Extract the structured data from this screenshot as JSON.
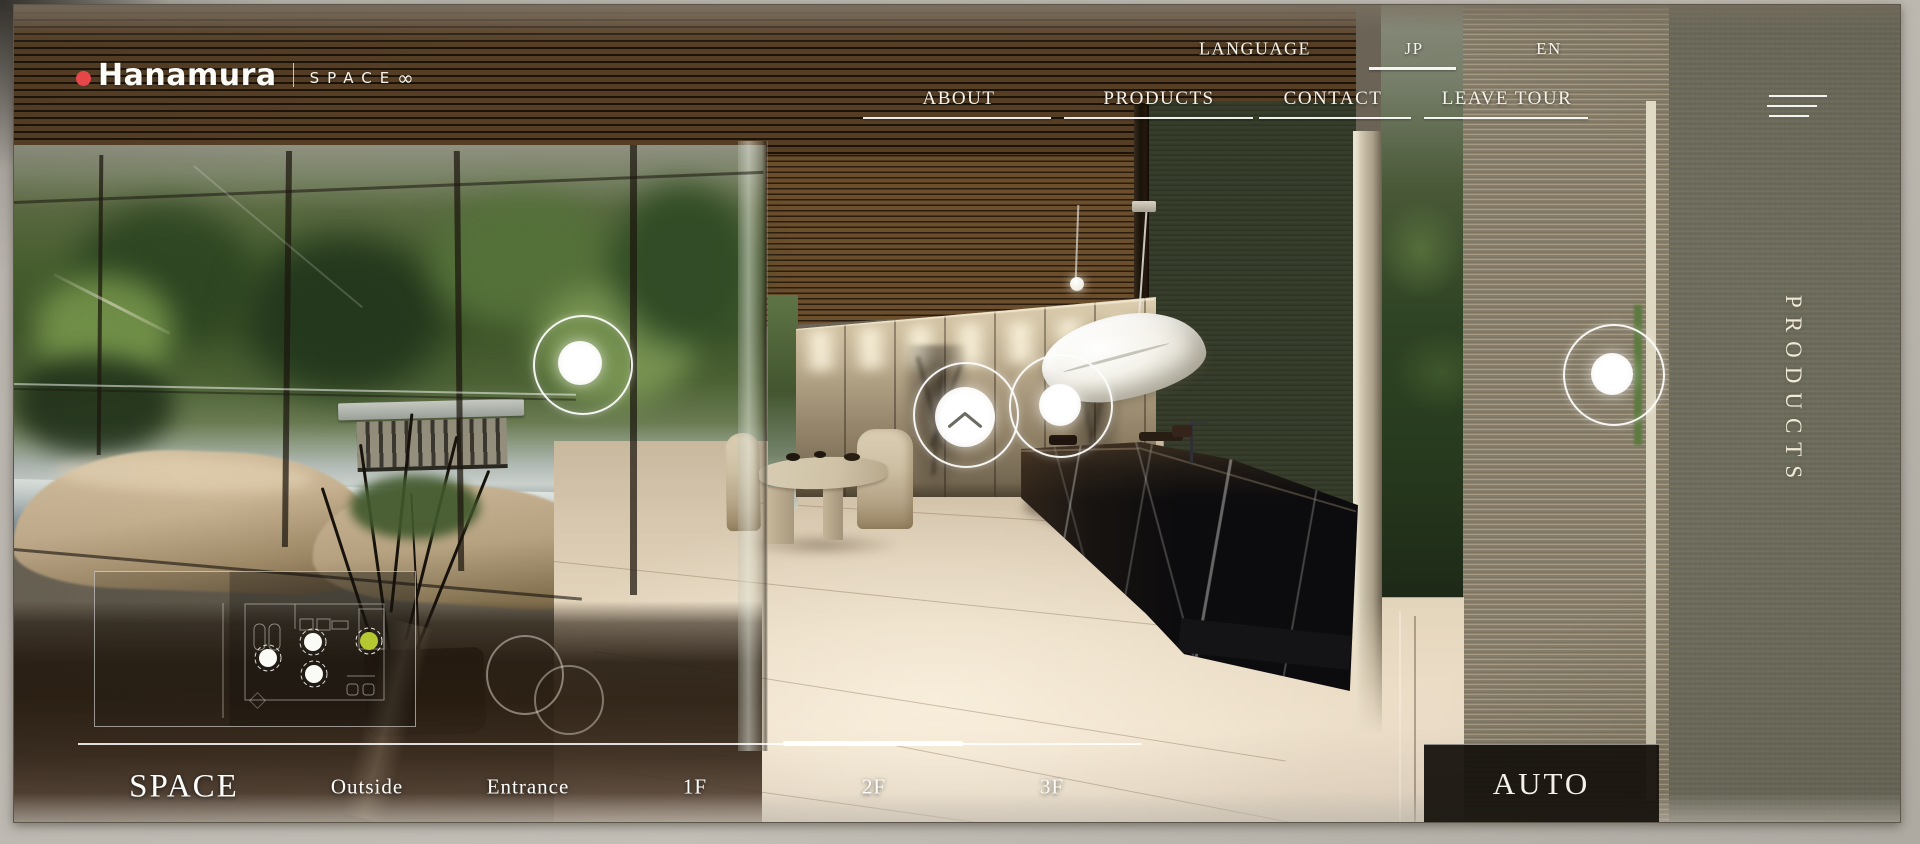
{
  "brand": {
    "name": "Hanamura",
    "sub": "SPACE",
    "sub_symbol": "∞"
  },
  "nav": {
    "language_label": "LANGUAGE",
    "languages": [
      {
        "code": "JP",
        "active": true
      },
      {
        "code": "EN",
        "active": false
      }
    ],
    "items": [
      {
        "label": "ABOUT"
      },
      {
        "label": "PRODUCTS"
      },
      {
        "label": "CONTACT"
      },
      {
        "label": "LEAVE TOUR"
      }
    ]
  },
  "right_rail": {
    "vertical_label": "PRODUCTS"
  },
  "bottom_bar": {
    "section_label": "SPACE",
    "floors": [
      {
        "label": "Outside",
        "active": false
      },
      {
        "label": "Entrance",
        "active": false
      },
      {
        "label": "1F",
        "active": false
      },
      {
        "label": "2F",
        "active": true
      },
      {
        "label": "3F",
        "active": false
      }
    ],
    "active_floor": "2F",
    "auto_label": "AUTO"
  },
  "colors": {
    "logo_dot": "#e8474a",
    "minimap_marker_active": "#b5c832",
    "auto_button_bg": "#16120d",
    "nav_text": "#f5f3ec"
  }
}
